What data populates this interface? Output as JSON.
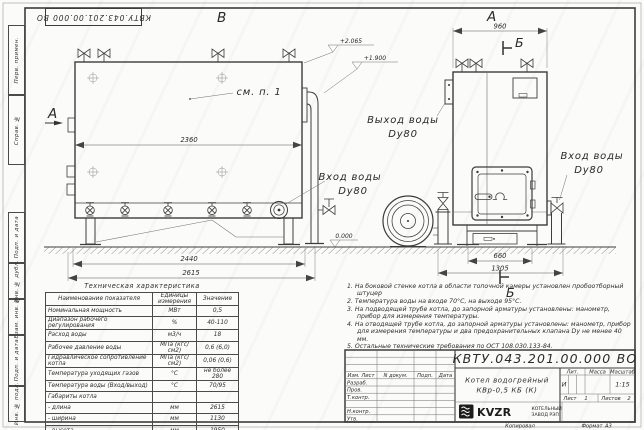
{
  "doc": {
    "number": "КВТУ.043.201.00.000  ВО",
    "format_label": "Формат",
    "format_value": "А3",
    "copied_label": "Копировал"
  },
  "frame_strips": {
    "items": [
      "Перв. примен.",
      "Справ. №",
      "Подп. и дата",
      "Инв. № дубл.",
      "Взам. инв. №",
      "Подп. и дата",
      "Инв. № подл."
    ]
  },
  "views": {
    "front": {
      "label": "В",
      "section_label": "А",
      "see_note": "см. п. 1",
      "dim_width": "2360",
      "dim_base": "2440",
      "dim_total": "2615",
      "elev_top": "+2.065",
      "elev_mid": "+1.900",
      "elev_zero": "0.000",
      "inlet_line1": "Вход воды",
      "inlet_line2": "Dy80"
    },
    "side": {
      "label": "А",
      "section_label": "Б",
      "dim_width": "960",
      "dim_ash": "660",
      "dim_base": "1305",
      "outlet_line1": "Выход воды",
      "outlet_line2": "Dy80",
      "inlet_line1": "Вход воды",
      "inlet_line2": "Dy80"
    }
  },
  "tech_table": {
    "title": "Техническая характеристика",
    "col_name": "Наименование показателя",
    "col_units": "Единицы измерения",
    "col_value": "Значение",
    "rows": [
      [
        "Номинальная мощность",
        "МВт",
        "0,5"
      ],
      [
        "Диапазон рабочего регулирования",
        "%",
        "40-110"
      ],
      [
        "Расход воды",
        "м3/ч",
        "18"
      ],
      [
        "Рабочее давление воды",
        "МПа (кгс/см2)",
        "0,6 (6,0)"
      ],
      [
        "Гидравлическое сопротивление котла",
        "МПа (кгс/см2)",
        "0,06 (0,6)"
      ],
      [
        "Температура уходящих газов",
        "°С",
        "не более 280"
      ],
      [
        "Температура воды (Вход/выход)",
        "°С",
        "70/95"
      ],
      [
        "Габариты котла",
        "",
        ""
      ],
      [
        "- длина",
        "мм",
        "2615"
      ],
      [
        "- ширина",
        "мм",
        "1130"
      ],
      [
        "- высота",
        "мм",
        "1950"
      ]
    ]
  },
  "notes": {
    "items": [
      "1.  На боковой стенке котла в области топочной камеры установлен пробоотборный штуцер",
      "2.  Температура воды на входе 70°С, на выходе 95°С.",
      "3.  На подводящей трубе котла, до запорной арматуры установлены: манометр, прибор для измерения температуры.",
      "4.  На отводящей трубе котла, до запорной арматуры установлены: манометр, прибор для измерения температуры и два предохранительных клапана  Dу не менее 40 мм.",
      "5.  Остальные технические требования по ОСТ 108.030.133-84."
    ]
  },
  "title_block": {
    "cols": [
      "Изм. Лист",
      "N докум.",
      "Подп.",
      "Дата"
    ],
    "row_labels": [
      "Разраб.",
      "Пров.",
      "Т.контр.",
      "Н.контр.",
      "Утв."
    ],
    "doc_title_line1": "Котел водогрейный",
    "doc_title_line2": "КВр-0,5  КБ  (К)",
    "lit_label": "Лит.",
    "lit_value": "И",
    "mass_label": "Масса",
    "scale_label": "Масштаб",
    "scale_value": "1:15",
    "sheet_label": "Лист",
    "sheet_value": "1",
    "sheets_label": "Листов",
    "sheets_value": "2",
    "logo_text": "KVZR",
    "org_line1": "КОТЕЛЬНЫЙ",
    "org_line2": "ЗАВОД РЭП"
  }
}
